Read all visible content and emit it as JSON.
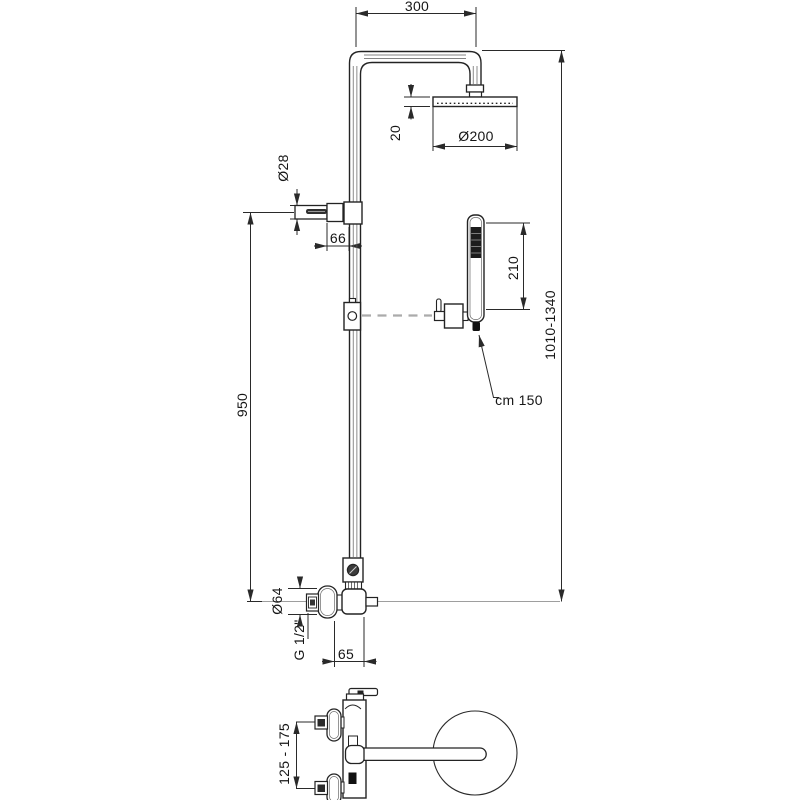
{
  "drawing": {
    "type": "shower-column-technical-drawing",
    "line_color": "#2a2a2a",
    "centerline_color": "#9e9e9e"
  },
  "dimensions": {
    "top_width": "300",
    "head_diameter": "Ø200",
    "head_thickness": "20",
    "pipe_diameter": "Ø28",
    "bracket_offset": "66",
    "handshower_length": "210",
    "total_height": "1010-1340",
    "column_height": "950",
    "hose_length": "cm 150",
    "escutcheon_diameter": "Ø64",
    "thread": "G 1/2\"",
    "wall_offset": "65",
    "inlet_spacing": "125 - 175"
  }
}
